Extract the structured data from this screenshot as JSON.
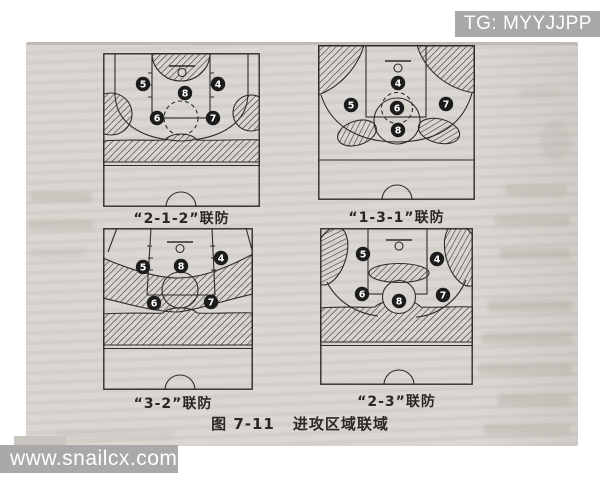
{
  "page": {
    "watermark_top": "TG: MYYJJPP",
    "watermark_bottom": "www.snailcx.com",
    "caption_prefix": "图 7-11",
    "caption_title": "进攻区域联域"
  },
  "colors": {
    "paper": "#d8d4cf",
    "ink": "#2e2c28",
    "player_disc": "#1c1c1c",
    "player_digit": "#ffffff",
    "watermark_bg": "#a9a9a9",
    "watermark_text": "#ffffff"
  },
  "diagrams": [
    {
      "id": "2-1-2",
      "label": "“2-1-2”联防",
      "players": [
        {
          "n": "5",
          "x": 40,
          "y": 31
        },
        {
          "n": "4",
          "x": 115,
          "y": 31
        },
        {
          "n": "8",
          "x": 82,
          "y": 40
        },
        {
          "n": "6",
          "x": 54,
          "y": 65
        },
        {
          "n": "7",
          "x": 110,
          "y": 65
        }
      ]
    },
    {
      "id": "1-3-1",
      "label": "“1-3-1”联防",
      "players": [
        {
          "n": "4",
          "x": 80,
          "y": 38
        },
        {
          "n": "5",
          "x": 33,
          "y": 60
        },
        {
          "n": "6",
          "x": 79,
          "y": 63
        },
        {
          "n": "7",
          "x": 128,
          "y": 59
        },
        {
          "n": "8",
          "x": 80,
          "y": 85
        }
      ]
    },
    {
      "id": "3-2",
      "label": "“3-2”联防",
      "players": [
        {
          "n": "5",
          "x": 40,
          "y": 39
        },
        {
          "n": "8",
          "x": 78,
          "y": 38
        },
        {
          "n": "4",
          "x": 118,
          "y": 30
        },
        {
          "n": "6",
          "x": 51,
          "y": 75
        },
        {
          "n": "7",
          "x": 108,
          "y": 74
        }
      ]
    },
    {
      "id": "2-3",
      "label": "“2-3”联防",
      "players": [
        {
          "n": "5",
          "x": 43,
          "y": 26
        },
        {
          "n": "4",
          "x": 117,
          "y": 31
        },
        {
          "n": "6",
          "x": 42,
          "y": 66
        },
        {
          "n": "7",
          "x": 123,
          "y": 67
        },
        {
          "n": "8",
          "x": 79,
          "y": 73
        }
      ]
    }
  ]
}
